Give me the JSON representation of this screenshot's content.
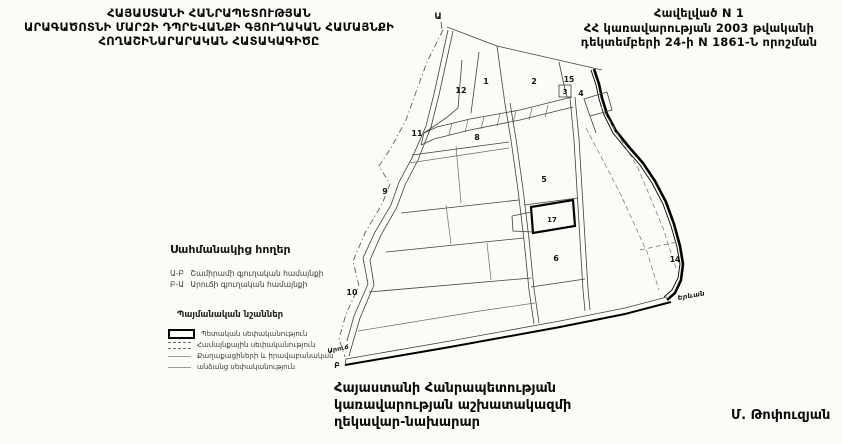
{
  "header_left": {
    "line1": "ՀԱՅԱՍՏԱՆԻ ՀԱՆՐԱՊԵՏՈՒԹՅԱՆ",
    "line2": "ԱՐԱԳԱԾՈՏՆԻ ՄԱՐԶԻ ԴՊՐԵՎԱՆՔԻ ԳՅՈՒՂԱԿԱՆ ՀԱՄԱՅՆՔԻ",
    "line3": "ՀՈՂԱՇԻՆԱՐԱՐԱԿԱՆ ՀԱՏԱԿԱԳԻԾԸ"
  },
  "header_right": {
    "line1": "Հավելված N 1",
    "line2": "ՀՀ կառավարության 2003 թվականի",
    "line3": "դեկտեմբերի 24-ի N 1861-Ն որոշման"
  },
  "legend_adjacent": {
    "title": "Սահմանակից հողեր",
    "item1_code": "Ա-Բ",
    "item1_label": "Շամիրամի գյուղական համայնքի",
    "item2_code": "Բ-Ա",
    "item2_label": "Արուճի գյուղական համայնքի"
  },
  "legend_signs": {
    "title": "Պայմանական նշաններ",
    "item1": "Պետական սեփականություն",
    "item2": "Համայնքային սեփականություն",
    "item3": "Քաղաքացիների և իրավաբանական",
    "item4": "անձանց սեփականություն"
  },
  "map": {
    "point_top": "Ա",
    "point_bottom": "Բ",
    "label_yerevan": "Երևան",
    "label_aruch": "Արուճ",
    "parcels": {
      "p1": "1",
      "p2": "2",
      "p3": "3",
      "p4": "4",
      "p5": "5",
      "p6": "6",
      "p8": "8",
      "p9": "9",
      "p10": "10",
      "p11": "11",
      "p12": "12",
      "p14": "14",
      "p15": "15",
      "p17": "17"
    }
  },
  "footer": {
    "line1": "Հայաստանի Հանրապետության",
    "line2": "կառավարության աշխատակազմի",
    "line3": "ղեկավար-նախարար",
    "signature": "Մ. Թոփուզյան"
  }
}
